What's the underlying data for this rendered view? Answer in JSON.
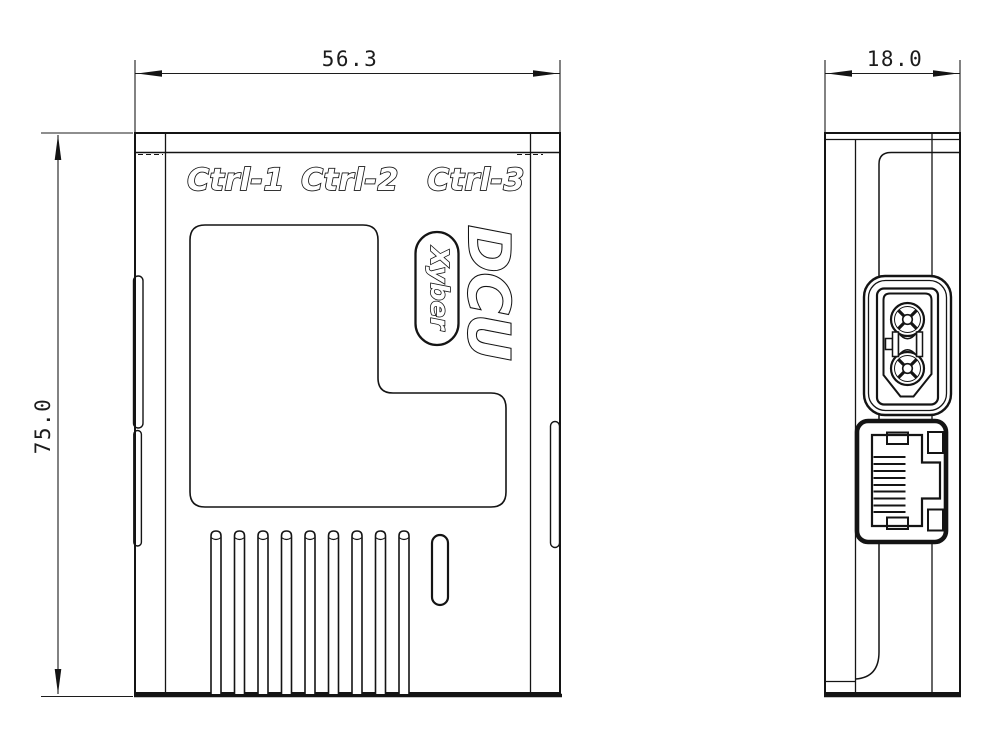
{
  "front_view": {
    "labels": {
      "ctrl1": "Ctrl-1",
      "ctrl2": "Ctrl-2",
      "ctrl3": "Ctrl-3"
    },
    "logo": "DCU",
    "badge": "Xyber",
    "vent_slot_count": 9
  },
  "side_view": {
    "power_connector_icon": "xt30-power-connector",
    "ethernet_icon": "rj45-ethernet-port"
  },
  "dimensions": {
    "front_width": "56.3",
    "front_height": "75.0",
    "side_depth": "18.0"
  },
  "colors": {
    "line": "#141414",
    "background": "#ffffff"
  }
}
